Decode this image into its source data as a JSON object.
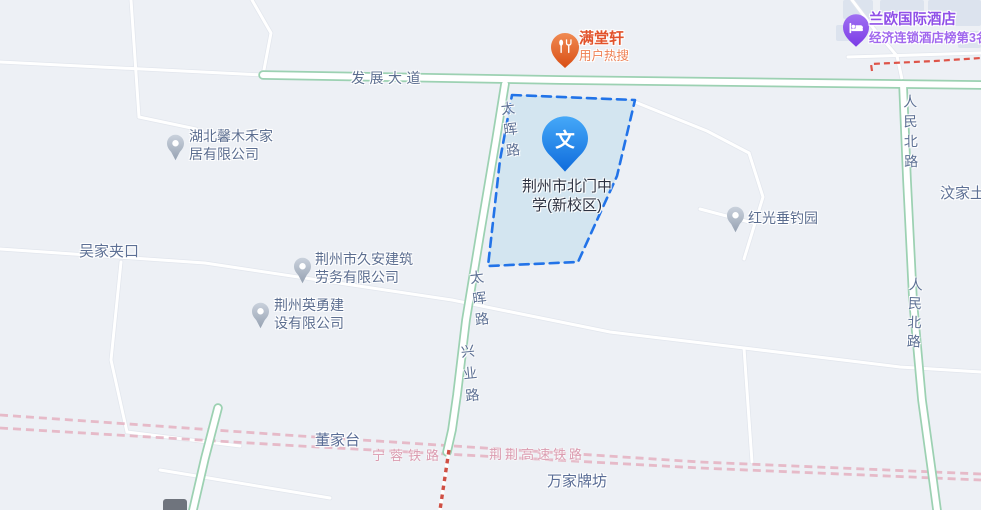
{
  "map_poi": {
    "school": {
      "glyph": "文",
      "line1": "荆州市北门中",
      "line2": "学(新校区)"
    },
    "mantangxuan": {
      "name": "满堂轩",
      "subtitle": "用户热搜"
    },
    "hotel": {
      "name": "兰欧国际酒店",
      "subtitle": "经济连锁酒店榜第3名"
    },
    "xinmuhe": {
      "line1": "湖北馨木禾家",
      "line2": "居有限公司"
    },
    "wujiajiakou": {
      "name": "吴家夹口"
    },
    "jiuan": {
      "line1": "荆州市久安建筑",
      "line2": "劳务有限公司"
    },
    "yingyong": {
      "line1": "荆州英勇建",
      "line2": "设有限公司"
    },
    "hongguang": {
      "name": "红光垂钓园"
    },
    "wenjia": {
      "name": "汶家土"
    },
    "dongjiatai": {
      "name": "董家台"
    },
    "wanjiapaifang": {
      "name": "万家牌坊"
    }
  },
  "roads": {
    "fazhan_dadao": "发展大道",
    "taihui_lu_upper": "太晖路",
    "taihui_lu_lower": "太晖路",
    "xingye_lu": "兴业路",
    "renmin_beilu_upper": "人民北路",
    "renmin_beilu_lower": "人民北路"
  },
  "railways": {
    "ningrong": "宁蓉铁路",
    "jingjing_gaosu": "荆荆高速铁路"
  },
  "colors": {
    "map_background": "#edf0f5",
    "highlight_fill": "#d3e5f0",
    "highlight_border": "#2273e8",
    "marker_blue": "#1b7ae4",
    "marker_orange": "#e4572e",
    "marker_purple": "#8f55ea",
    "marker_gray": "#a8b3c2",
    "road_green_edge": "#9cd1b2",
    "railway_pink": "#e6bac8",
    "boundary_red": "#de5449",
    "label_blue_gray": "#5c6e90"
  }
}
